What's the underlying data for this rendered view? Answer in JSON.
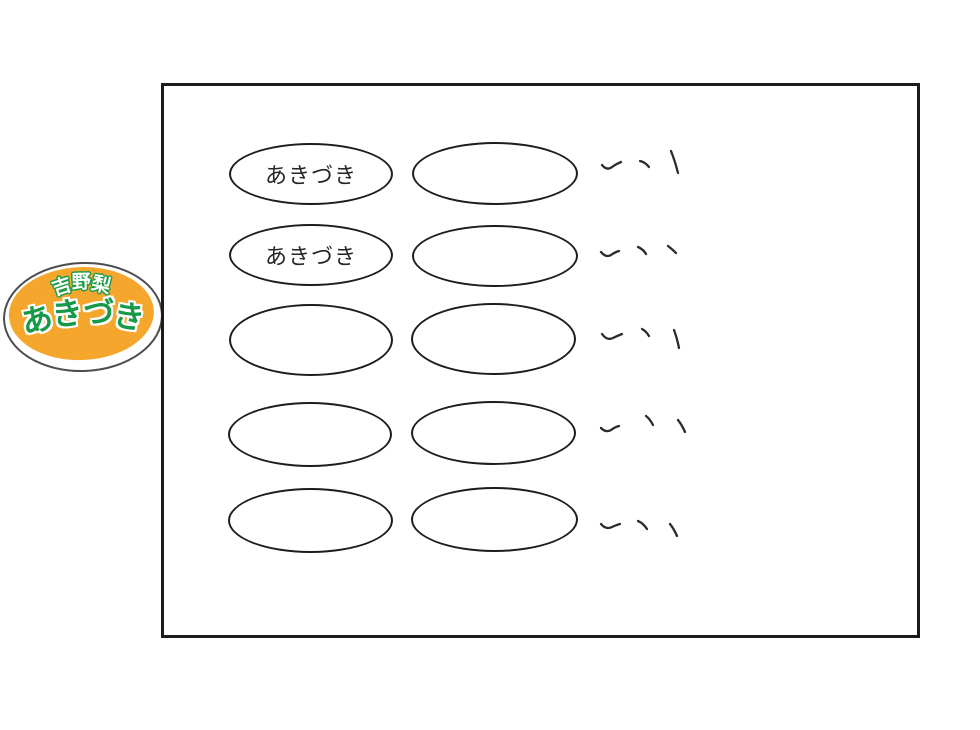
{
  "sticker": {
    "brand_text": "吉野梨",
    "variety_text": "あきづき",
    "colors": {
      "fill_orange": "#f4a72c",
      "ring_white": "#ffffff",
      "outline_gray": "#4d4d4d",
      "green": "#1e9c46"
    }
  },
  "sheet": {
    "frame_color": "#1b1b1b",
    "rows": [
      {
        "left_label": "あきづき",
        "right_label": "",
        "tally_marks": 3
      },
      {
        "left_label": "あきづき",
        "right_label": "",
        "tally_marks": 3
      },
      {
        "left_label": "",
        "right_label": "",
        "tally_marks": 3
      },
      {
        "left_label": "",
        "right_label": "",
        "tally_marks": 3
      },
      {
        "left_label": "",
        "right_label": "",
        "tally_marks": 3
      }
    ]
  }
}
